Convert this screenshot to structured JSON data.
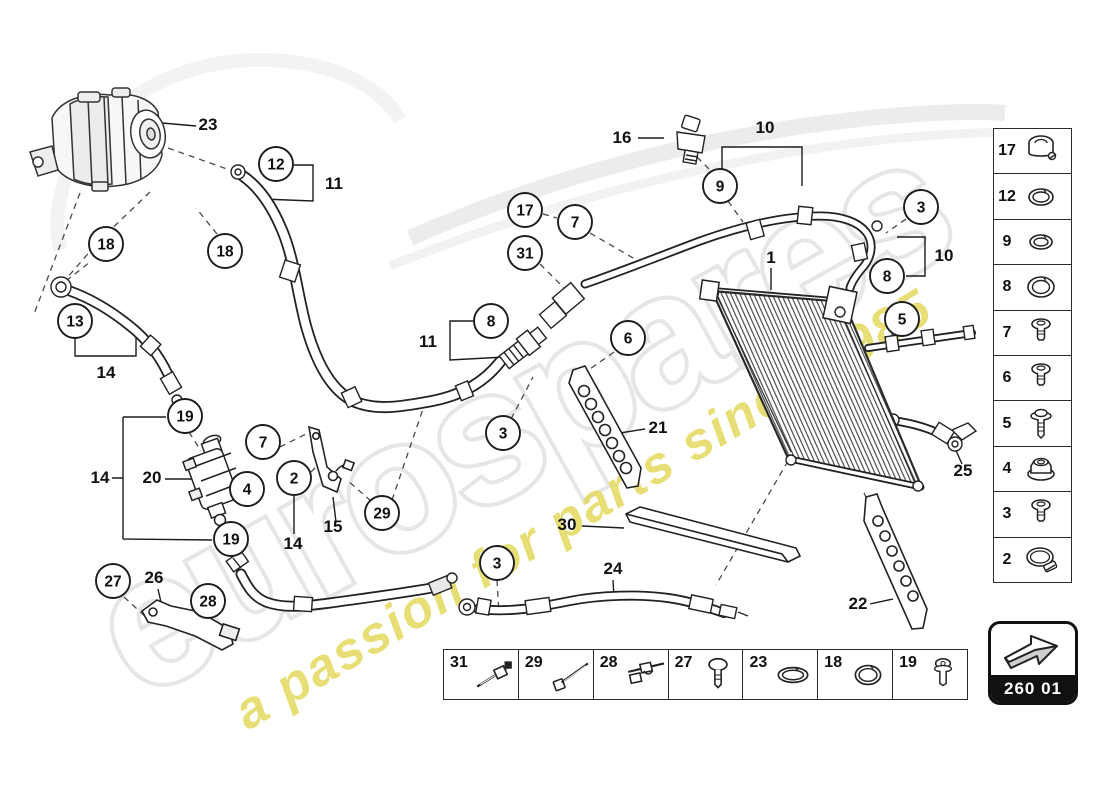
{
  "watermark": {
    "brand": "eurospares",
    "tagline": "a passion for parts since 1985",
    "brand_outline_color": "#e6e6e6",
    "tagline_color": "#e3da5f"
  },
  "badge": {
    "code": "260 01"
  },
  "sidebar": {
    "rows": [
      {
        "label": "17",
        "icon": "pipe-clamp"
      },
      {
        "label": "12",
        "icon": "o-ring-split"
      },
      {
        "label": "9",
        "icon": "o-ring-small"
      },
      {
        "label": "8",
        "icon": "o-ring-large"
      },
      {
        "label": "7",
        "icon": "bolt"
      },
      {
        "label": "6",
        "icon": "bolt"
      },
      {
        "label": "5",
        "icon": "bolt-long"
      },
      {
        "label": "4",
        "icon": "flange-nut"
      },
      {
        "label": "3",
        "icon": "bolt"
      },
      {
        "label": "2",
        "icon": "hose-clamp"
      }
    ]
  },
  "legend": {
    "cells": [
      {
        "label": "31",
        "icon": "cable-tie-mount"
      },
      {
        "label": "29",
        "icon": "cable-tie"
      },
      {
        "label": "28",
        "icon": "tie-clip"
      },
      {
        "label": "27",
        "icon": "screw"
      },
      {
        "label": "23",
        "icon": "o-ring-flat"
      },
      {
        "label": "18",
        "icon": "o-ring"
      },
      {
        "label": "19",
        "icon": "bolt-small"
      }
    ]
  },
  "diagram": {
    "circled_callouts": [
      {
        "label": "12",
        "x": 276,
        "y": 164
      },
      {
        "label": "18",
        "x": 106,
        "y": 244
      },
      {
        "label": "18",
        "x": 225,
        "y": 251
      },
      {
        "label": "13",
        "x": 75,
        "y": 321
      },
      {
        "label": "19",
        "x": 185,
        "y": 416
      },
      {
        "label": "7",
        "x": 263,
        "y": 442
      },
      {
        "label": "4",
        "x": 247,
        "y": 489
      },
      {
        "label": "2",
        "x": 294,
        "y": 478
      },
      {
        "label": "19",
        "x": 231,
        "y": 539
      },
      {
        "label": "27",
        "x": 113,
        "y": 581
      },
      {
        "label": "28",
        "x": 208,
        "y": 601
      },
      {
        "label": "29",
        "x": 382,
        "y": 513
      },
      {
        "label": "3",
        "x": 497,
        "y": 563
      },
      {
        "label": "3",
        "x": 503,
        "y": 433
      },
      {
        "label": "8",
        "x": 491,
        "y": 321
      },
      {
        "label": "6",
        "x": 628,
        "y": 338
      },
      {
        "label": "17",
        "x": 525,
        "y": 210
      },
      {
        "label": "7",
        "x": 575,
        "y": 222
      },
      {
        "label": "31",
        "x": 525,
        "y": 253
      },
      {
        "label": "9",
        "x": 720,
        "y": 186
      },
      {
        "label": "3",
        "x": 921,
        "y": 207
      },
      {
        "label": "8",
        "x": 887,
        "y": 276
      },
      {
        "label": "5",
        "x": 902,
        "y": 319
      }
    ],
    "plain_labels": [
      {
        "label": "23",
        "x": 208,
        "y": 130
      },
      {
        "label": "11",
        "x": 334,
        "y": 189
      },
      {
        "label": "14",
        "x": 106,
        "y": 378
      },
      {
        "label": "14",
        "x": 100,
        "y": 483
      },
      {
        "label": "20",
        "x": 152,
        "y": 483
      },
      {
        "label": "15",
        "x": 333,
        "y": 532
      },
      {
        "label": "14",
        "x": 293,
        "y": 549
      },
      {
        "label": "26",
        "x": 154,
        "y": 583
      },
      {
        "label": "16",
        "x": 622,
        "y": 143
      },
      {
        "label": "10",
        "x": 765,
        "y": 133
      },
      {
        "label": "1",
        "x": 771,
        "y": 263
      },
      {
        "label": "11",
        "x": 428,
        "y": 347
      },
      {
        "label": "21",
        "x": 658,
        "y": 433
      },
      {
        "label": "30",
        "x": 567,
        "y": 530
      },
      {
        "label": "24",
        "x": 613,
        "y": 574
      },
      {
        "label": "10",
        "x": 944,
        "y": 261
      },
      {
        "label": "25",
        "x": 963,
        "y": 476
      },
      {
        "label": "22",
        "x": 858,
        "y": 609
      }
    ]
  }
}
